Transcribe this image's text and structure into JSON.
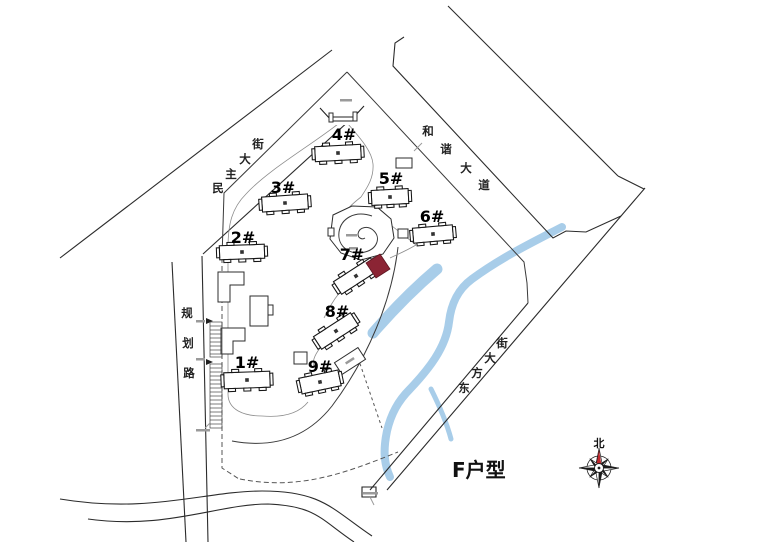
{
  "page": {
    "background": "#ffffff"
  },
  "site_plan": {
    "annotation": "F户型",
    "compass_label": "北",
    "colors": {
      "highlight": "#8b2434",
      "water": "#a8cde9",
      "line": "#2b2b2b",
      "compass_needle": "#c1272d"
    },
    "streets": [
      {
        "name": "民主大街",
        "chars": [
          {
            "c": "民",
            "x": 218,
            "y": 192
          },
          {
            "c": "主",
            "x": 231,
            "y": 178
          },
          {
            "c": "大",
            "x": 245,
            "y": 163
          },
          {
            "c": "街",
            "x": 258,
            "y": 148
          }
        ]
      },
      {
        "name": "和谐大道",
        "chars": [
          {
            "c": "和",
            "x": 428,
            "y": 135
          },
          {
            "c": "谐",
            "x": 446,
            "y": 153
          },
          {
            "c": "大",
            "x": 466,
            "y": 172
          },
          {
            "c": "道",
            "x": 484,
            "y": 189
          }
        ]
      },
      {
        "name": "规划路",
        "chars": [
          {
            "c": "规",
            "x": 187,
            "y": 317
          },
          {
            "c": "划",
            "x": 188,
            "y": 347
          },
          {
            "c": "路",
            "x": 189,
            "y": 377
          }
        ]
      },
      {
        "name": "东方大街",
        "chars": [
          {
            "c": "东",
            "x": 464,
            "y": 392
          },
          {
            "c": "方",
            "x": 477,
            "y": 377
          },
          {
            "c": "大",
            "x": 490,
            "y": 362
          },
          {
            "c": "街",
            "x": 502,
            "y": 347
          }
        ]
      }
    ],
    "buildings": [
      {
        "label": "1#",
        "lx": 247,
        "ly": 368,
        "cx": 247,
        "cy": 380,
        "w": 46,
        "h": 16,
        "rot": -2
      },
      {
        "label": "2#",
        "lx": 243,
        "ly": 243,
        "cx": 242,
        "cy": 252,
        "w": 45,
        "h": 14,
        "rot": -2
      },
      {
        "label": "3#",
        "lx": 283,
        "ly": 193,
        "cx": 285,
        "cy": 203,
        "w": 46,
        "h": 15,
        "rot": -4
      },
      {
        "label": "4#",
        "lx": 344,
        "ly": 140,
        "cx": 338,
        "cy": 153,
        "w": 46,
        "h": 15,
        "rot": -3
      },
      {
        "label": "5#",
        "lx": 391,
        "ly": 184,
        "cx": 390,
        "cy": 197,
        "w": 37,
        "h": 15,
        "rot": -3
      },
      {
        "label": "6#",
        "lx": 432,
        "ly": 222,
        "cx": 433,
        "cy": 234,
        "w": 40,
        "h": 15,
        "rot": -5
      },
      {
        "label": "7#",
        "lx": 352,
        "ly": 260,
        "cx": 356,
        "cy": 276,
        "w": 44,
        "h": 15,
        "rot": -33
      },
      {
        "label": "8#",
        "lx": 337,
        "ly": 317,
        "cx": 336,
        "cy": 331,
        "w": 44,
        "h": 15,
        "rot": -33
      },
      {
        "label": "9#",
        "lx": 320,
        "ly": 372,
        "cx": 320,
        "cy": 382,
        "w": 40,
        "h": 16,
        "rot": -12
      }
    ]
  }
}
